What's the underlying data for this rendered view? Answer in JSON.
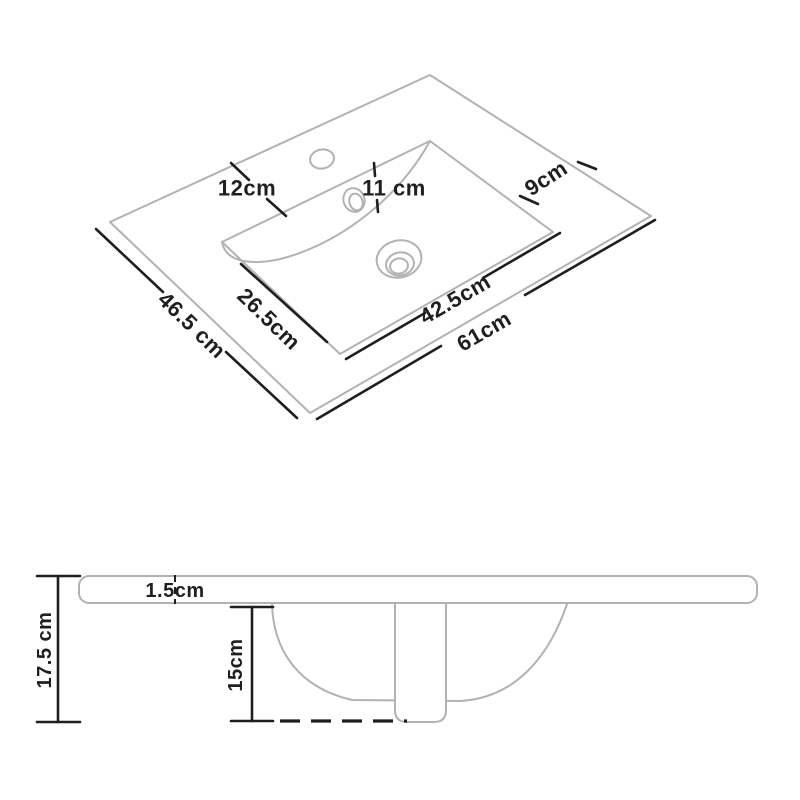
{
  "diagram_title": "sink-basin-dimension-drawing",
  "colors": {
    "outline": "#b2b2b2",
    "dimension": "#1f1f1f",
    "background": "#ffffff"
  },
  "top_view": {
    "description": "isometric top view of vanity basin countertop",
    "labels": {
      "left_ledge": "12cm",
      "hole_distance": "11 cm",
      "right_ledge": "9cm",
      "basin_side": "26.5cm",
      "basin_front": "42.5cm",
      "overall_front": "61cm",
      "overall_side": "46.5 cm"
    }
  },
  "side_view": {
    "description": "front cross-section view of basin",
    "labels": {
      "slab_thickness": "1.5cm",
      "overall_height": "17.5 cm",
      "basin_depth": "15cm"
    }
  }
}
